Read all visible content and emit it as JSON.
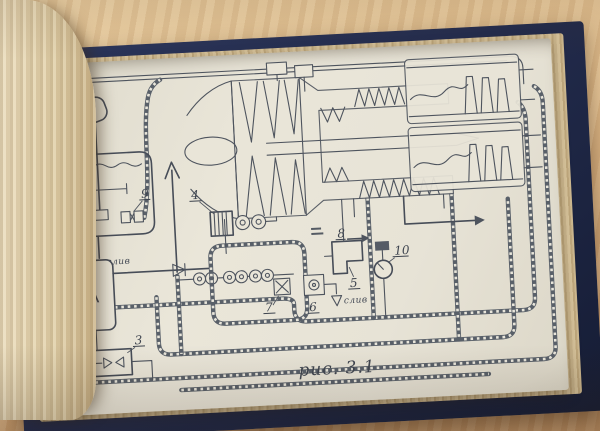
{
  "diagram": {
    "figure_caption": "рис. 3.1",
    "tma_label": "ТМА",
    "drain_label": "слив",
    "drain_label_2": "слив",
    "callouts": [
      "1",
      "2",
      "3",
      "4",
      "5",
      "6",
      "7",
      "8",
      "9",
      "10"
    ]
  },
  "palette": {
    "ink": "#4e545e",
    "page": "#e7e3d7",
    "cover_navy": "#232c4e",
    "wood": "#ddb88a"
  }
}
